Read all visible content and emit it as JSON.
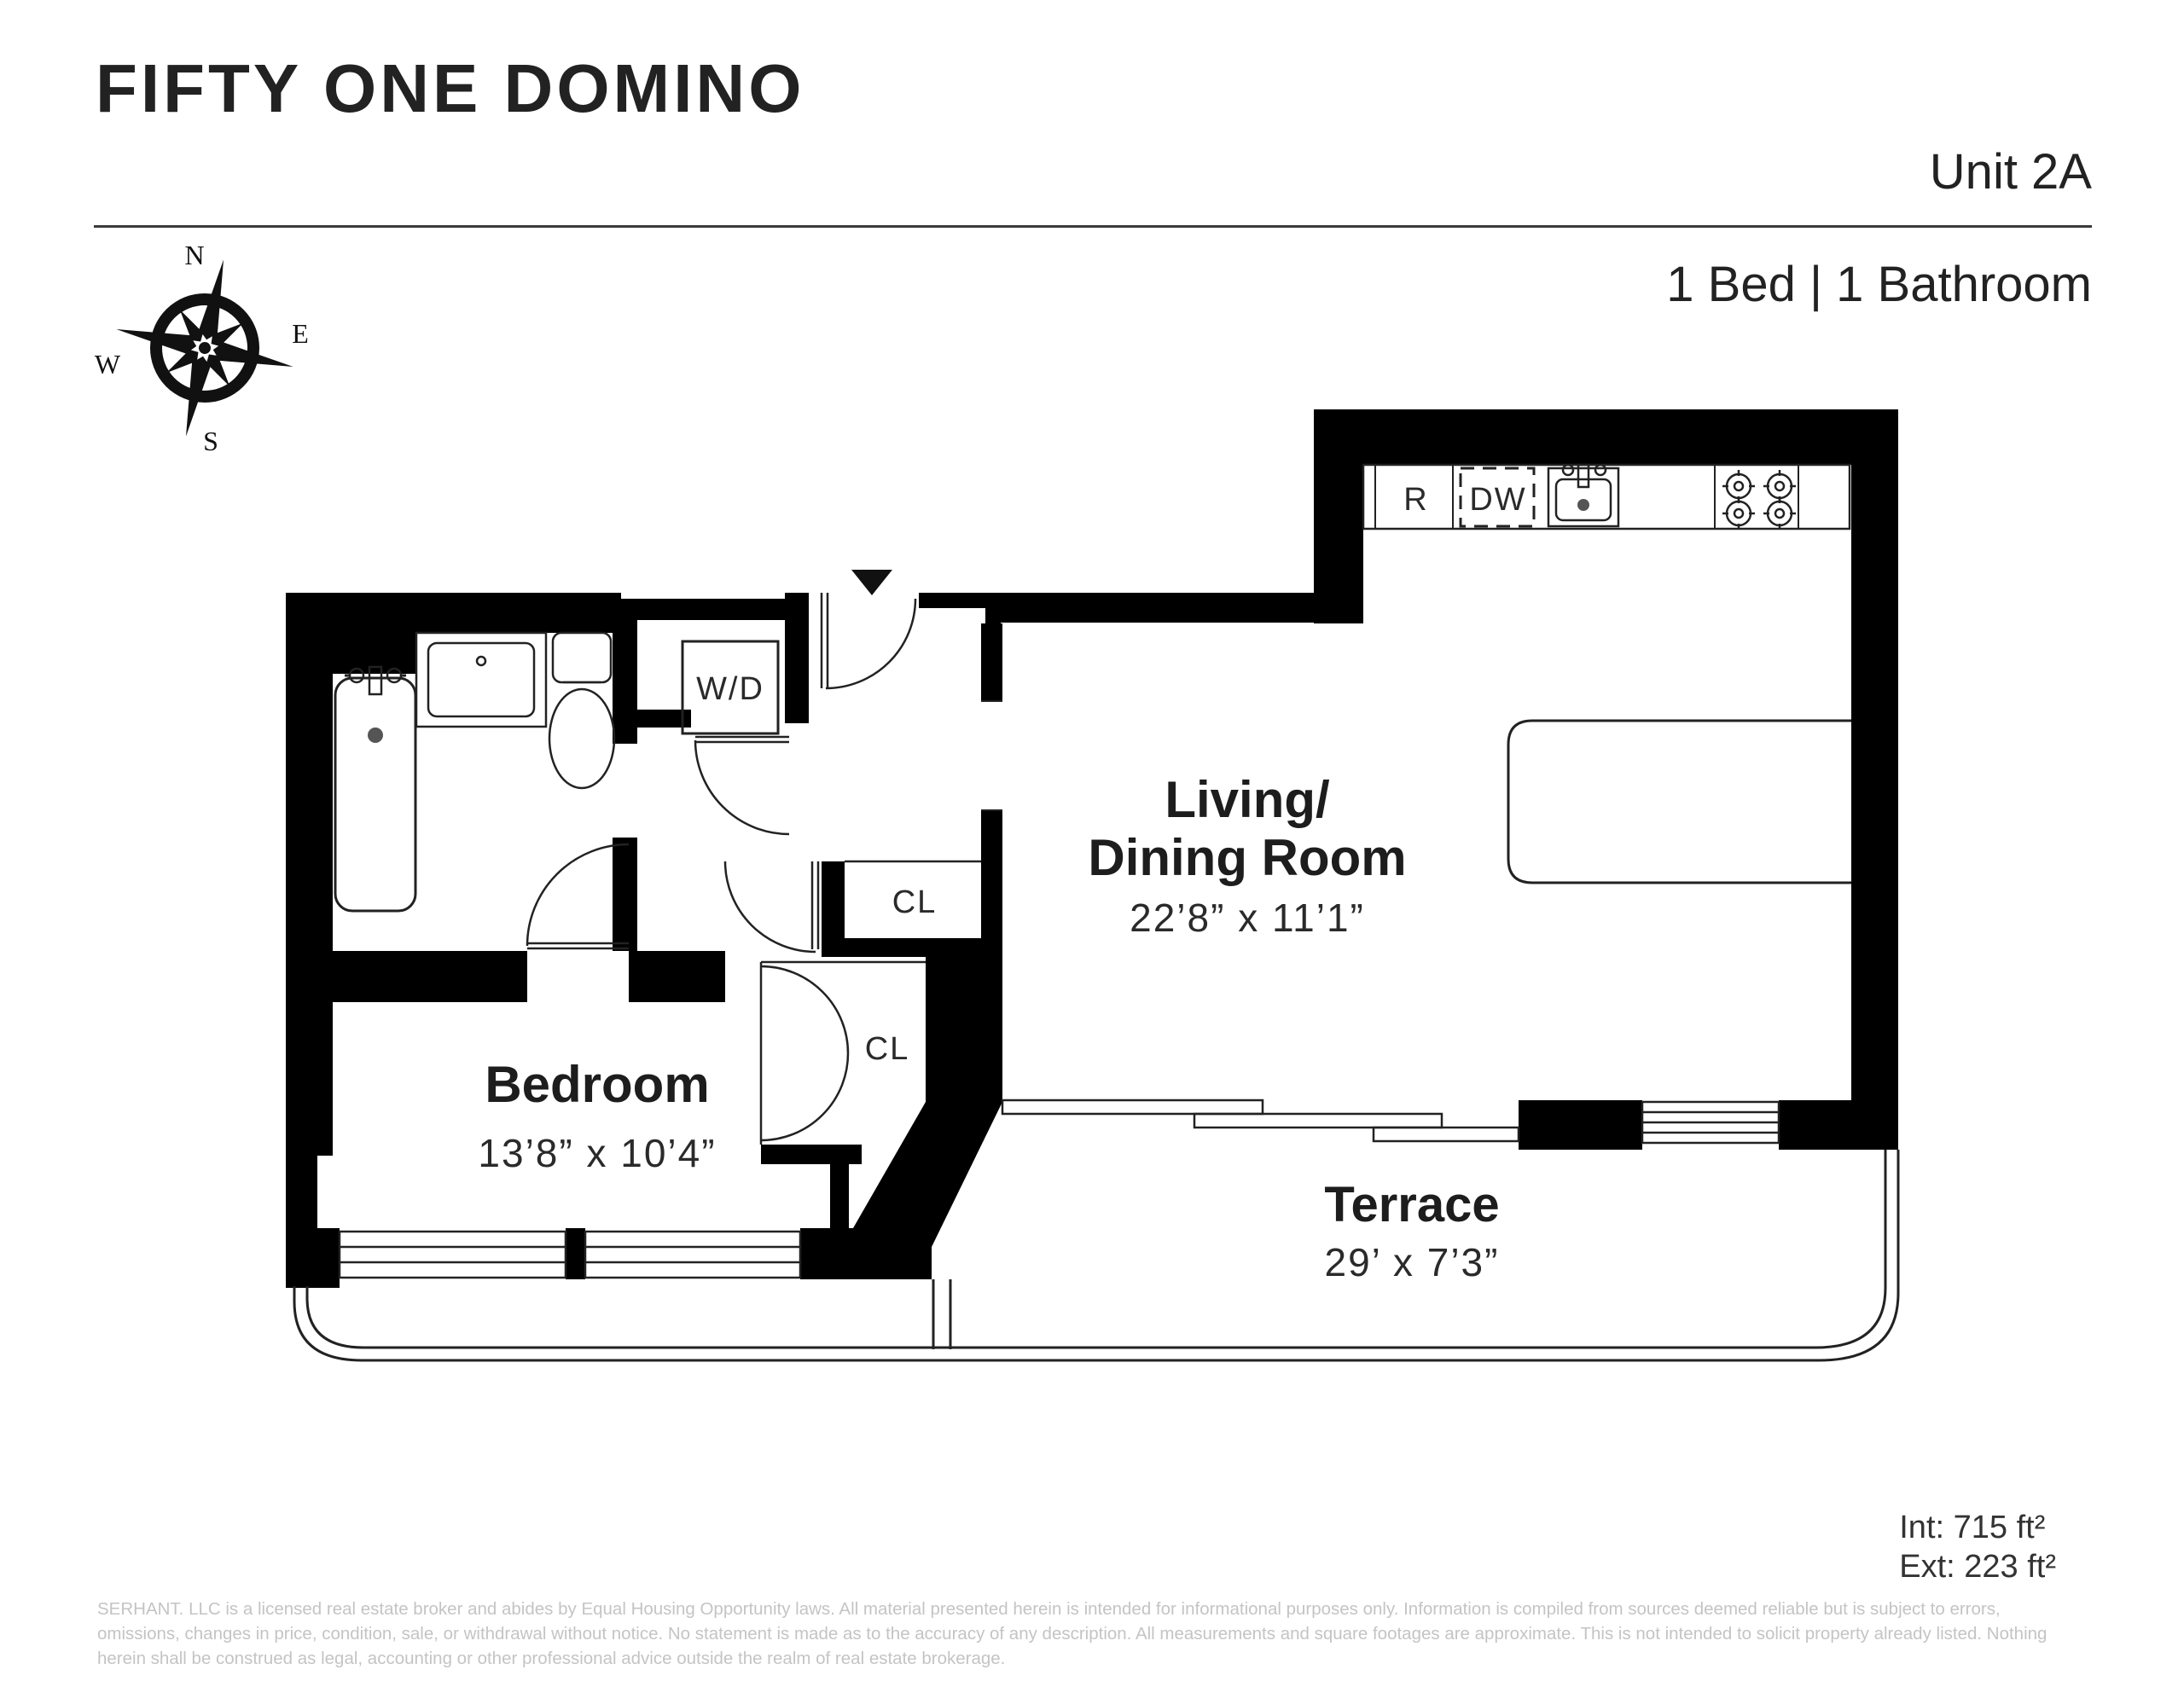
{
  "header": {
    "title": "FIFTY ONE DOMINO",
    "unit": "Unit 2A",
    "bed_bath": "1 Bed | 1 Bathroom"
  },
  "compass": {
    "n": "N",
    "e": "E",
    "s": "S",
    "w": "W"
  },
  "rooms": {
    "living": {
      "name_line1": "Living/",
      "name_line2": "Dining Room",
      "dims": "22’8” x 11’1”"
    },
    "bedroom": {
      "name": "Bedroom",
      "dims": "13’8” x 10’4”"
    },
    "terrace": {
      "name": "Terrace",
      "dims": "29’ x 7’3”"
    }
  },
  "fixtures": {
    "refrigerator": "R",
    "dishwasher": "DW",
    "washer_dryer": "W/D",
    "closet_upper": "CL",
    "closet_lower": "CL"
  },
  "areas": {
    "interior": "Int: 715 ft²",
    "exterior": "Ext: 223 ft²"
  },
  "disclaimer": {
    "line1": "SERHANT. LLC is a licensed real estate broker and abides by Equal Housing Opportunity laws. All material presented herein is intended for informational purposes only. Information is compiled from sources deemed reliable but is subject to errors,",
    "line2": "omissions, changes in price, condition, sale, or withdrawal without notice. No statement is made as to the accuracy of any description. All measurements and square footages are approximate. This is not intended to solicit property already listed. Nothing",
    "line3": "herein shall be construed as legal, accounting or other professional advice outside the realm of real estate brokerage."
  },
  "colors": {
    "wall": "#000000",
    "line": "#222222",
    "muted": "#c4c4c4"
  }
}
